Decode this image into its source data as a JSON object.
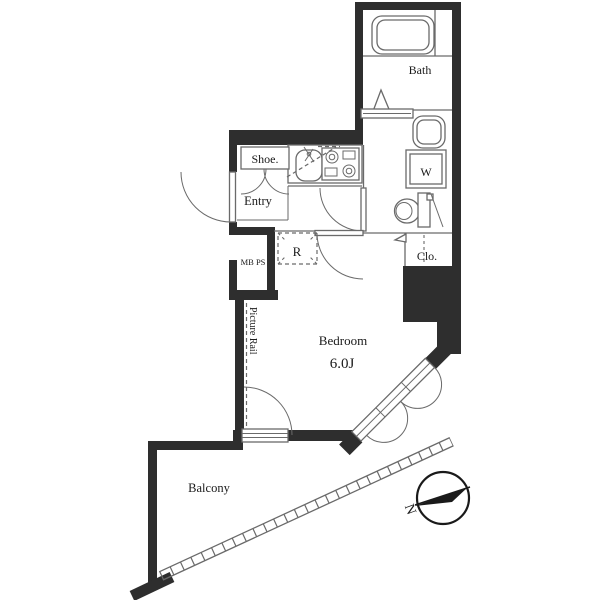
{
  "plan": {
    "rooms": {
      "bath": {
        "label": "Bath"
      },
      "shoe": {
        "label": "Shoe."
      },
      "entry": {
        "label": "Entry"
      },
      "washer": {
        "label": "W"
      },
      "fridge": {
        "label": "R"
      },
      "closet": {
        "label": "Clo."
      },
      "meter_box": {
        "label": "MB PS"
      },
      "bedroom": {
        "label": "Bedroom",
        "size": "6.0J"
      },
      "balcony": {
        "label": "Balcony"
      },
      "picture_rail": {
        "label": "Picture Rail"
      }
    },
    "compass": {
      "north": "N"
    },
    "colors": {
      "wall": "#2e2e2e",
      "line": "#6a6a6a",
      "text": "#1a1a1a",
      "bg": "#ffffff"
    }
  }
}
